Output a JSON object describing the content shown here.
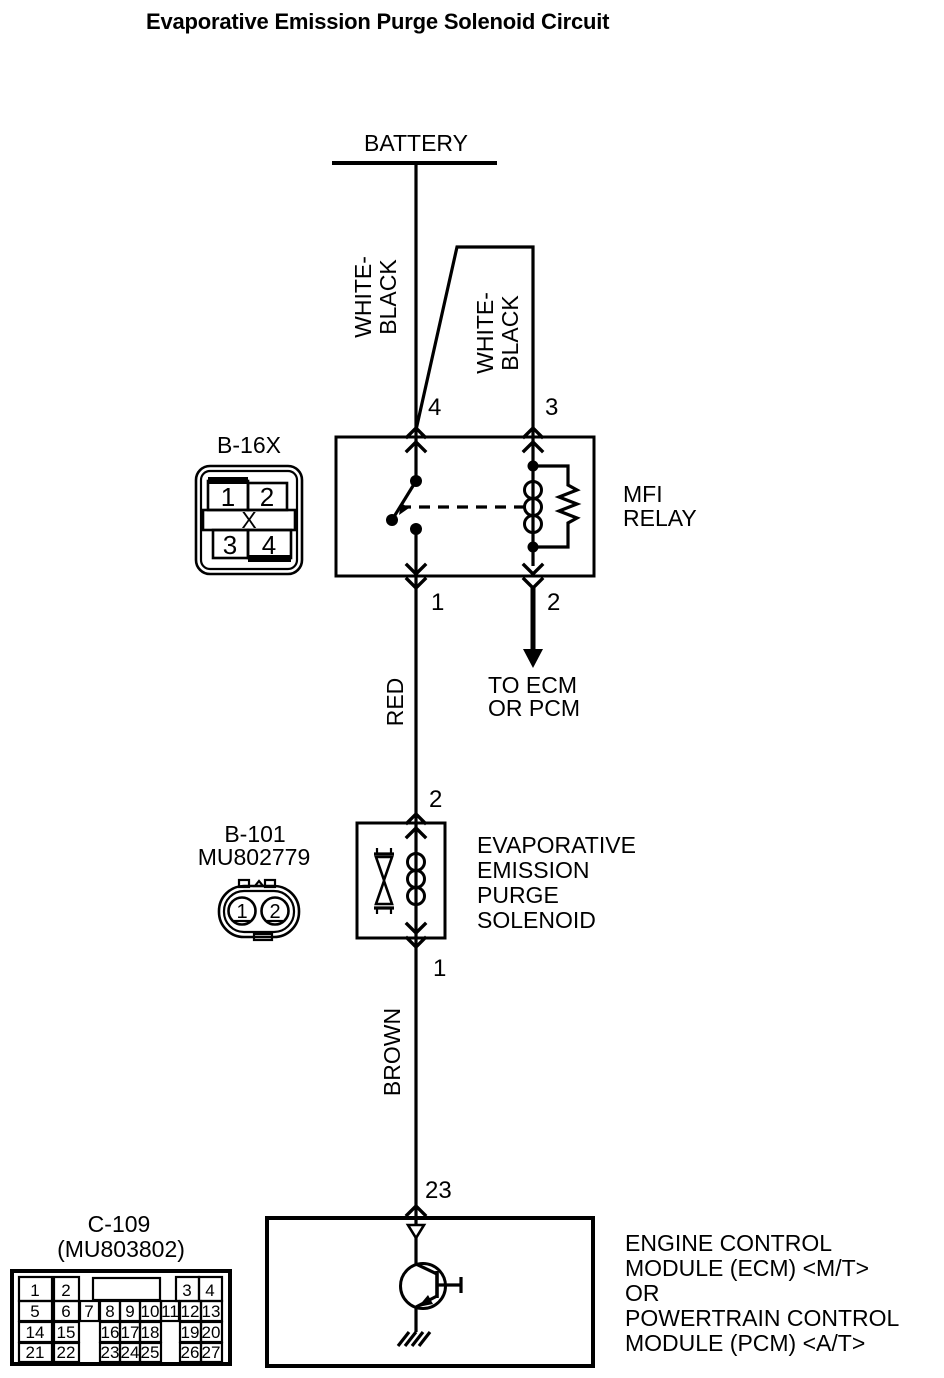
{
  "title": "Evaporative Emission Purge Solenoid Circuit",
  "battery": {
    "label": "BATTERY"
  },
  "wires": {
    "wb1": [
      "WHITE-",
      "BLACK"
    ],
    "wb2": [
      "WHITE-",
      "BLACK"
    ],
    "red": "RED",
    "brown": "BROWN"
  },
  "relay": {
    "label": [
      "MFI",
      "RELAY"
    ],
    "pins": {
      "top_left": "4",
      "top_right": "3",
      "bottom_left": "1",
      "bottom_right": "2"
    }
  },
  "branch": {
    "note": [
      "TO ECM",
      "OR PCM"
    ]
  },
  "solenoid": {
    "label": [
      "EVAPORATIVE",
      "EMISSION",
      "PURGE",
      "SOLENOID"
    ],
    "pins": {
      "top": "2",
      "bottom": "1"
    }
  },
  "ecm": {
    "pin": "23",
    "label": [
      "ENGINE CONTROL",
      "MODULE (ECM) <M/T>",
      "OR",
      "POWERTRAIN CONTROL",
      "MODULE (PCM) <A/T>"
    ]
  },
  "connector_b16x": {
    "label": "B-16X",
    "cells": [
      "1",
      "2",
      "X",
      "3",
      "4"
    ]
  },
  "connector_b101": {
    "label": "B-101",
    "part_no": "MU802779",
    "cells": [
      "1",
      "2"
    ]
  },
  "connector_c109": {
    "label": "C-109",
    "part_no": "(MU803802)",
    "row1": [
      "1",
      "2",
      "3",
      "4"
    ],
    "row2": [
      "5",
      "6",
      "7",
      "8",
      "9",
      "10",
      "11",
      "12",
      "13"
    ],
    "row3": [
      "14",
      "15",
      "16",
      "17",
      "18",
      "19",
      "20"
    ],
    "row4": [
      "21",
      "22",
      "23",
      "24",
      "25",
      "26",
      "27"
    ]
  },
  "colors": {
    "ink": "#000000",
    "background": "#ffffff"
  }
}
